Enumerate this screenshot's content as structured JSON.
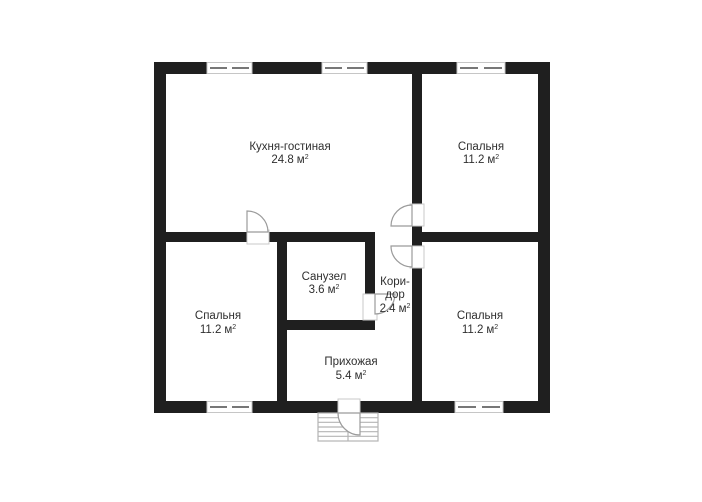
{
  "plan": {
    "background_color": "#ffffff",
    "wall_color": "#1f1f1f",
    "swing_line_color": "#9b9b9b",
    "stair_line_color": "#b4b4b4",
    "text_color": "#2f2f2f",
    "unit_sup": "2",
    "rooms": {
      "kitchen_living": {
        "name": "Кухня-гостиная",
        "area": "24.8",
        "unit": "м"
      },
      "bedroom_top_right": {
        "name": "Спальня",
        "area": "11.2",
        "unit": "м"
      },
      "bathroom": {
        "name": "Санузел",
        "area": "3.6",
        "unit": "м"
      },
      "corridor": {
        "name_line1": "Кори-",
        "name_line2": "дор",
        "area": "2.4",
        "unit": "м"
      },
      "bedroom_bottom_left": {
        "name": "Спальня",
        "area": "11.2",
        "unit": "м"
      },
      "hallway": {
        "name": "Прихожая",
        "area": "5.4",
        "unit": "м"
      },
      "bedroom_bottom_right": {
        "name": "Спальня",
        "area": "11.2",
        "unit": "м"
      }
    }
  }
}
